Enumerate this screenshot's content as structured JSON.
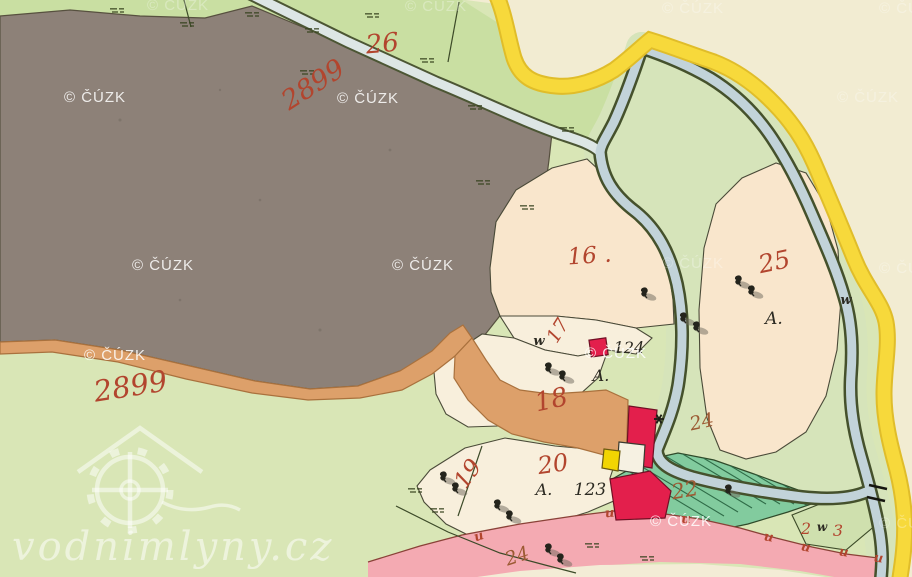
{
  "map_title": "historic cadastral map sheet",
  "watermarks": {
    "cuzk": "© ČÚZK",
    "site": "vodnimlyny.cz"
  },
  "parcels": {
    "n26": "26",
    "n2899_top": "2899",
    "n2899_bottom": "2899",
    "n16": "16 .",
    "n17": "17",
    "n18": "18",
    "n19": "19",
    "n20": "20",
    "n22": "22",
    "n23_left": "2",
    "n23_right": "3",
    "n24_stream": "24",
    "n24_bottom": "24",
    "n25": "25"
  },
  "buildings": {
    "n124": "124",
    "n123": "123"
  },
  "marks": {
    "a_parcel18": "A.",
    "a_parcel20": "A.",
    "a_parcel25": "A.",
    "w_left": "w",
    "w_right": "w",
    "w_23": "w",
    "u": "u"
  },
  "colors": {
    "meadow_green": "#d9e6b6",
    "field_green": "#c9dfa2",
    "strip_green": "#d6e4ba",
    "hatch_green": "#82cb9e",
    "hatch_line": "#2f6b47",
    "forest_gray": "#8d8178",
    "outside_cream": "#f2ecd2",
    "parcel_cream": "#f8efdc",
    "parcel_peach": "#f9e6cc",
    "stream_blue": "#c2d3d9",
    "stream_pale": "#dde6e5",
    "stream_edge": "#45512c",
    "road_yellow": "#f7d93b",
    "road_pink": "#f4aab2",
    "path_orange": "#dda06a",
    "building_red": "#e31f4c",
    "building_yellow": "#f2d502",
    "building_white": "#f6f1e2",
    "number_red": "#b2452e",
    "number_brown": "#9c5a33",
    "ink_black": "#2c2a22"
  }
}
